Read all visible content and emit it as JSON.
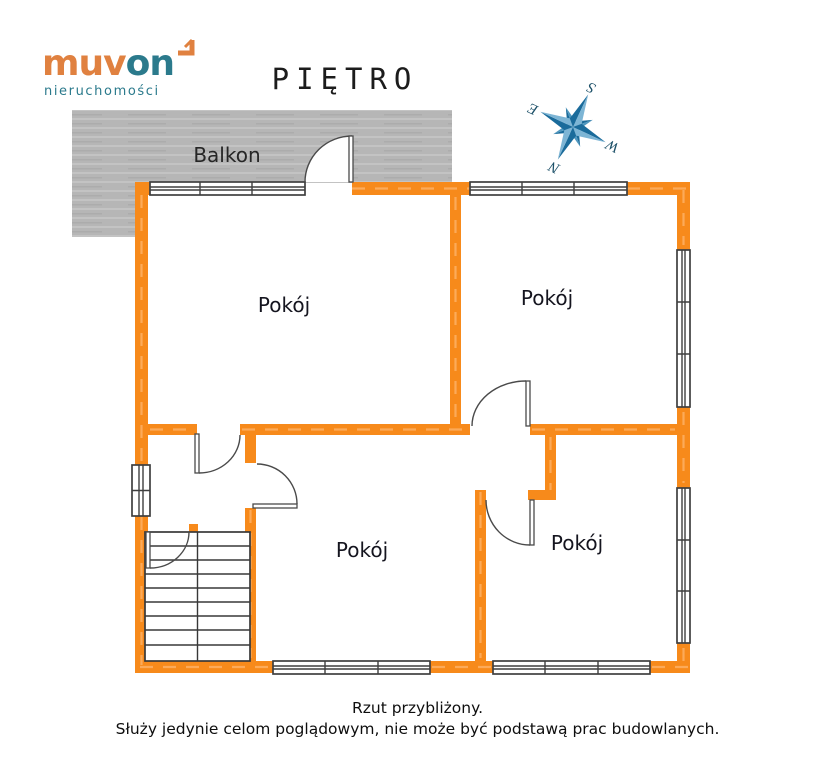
{
  "logo": {
    "brand_primary": "muv",
    "brand_secondary": "on",
    "tagline": "nieruchomości"
  },
  "title": "PIĘTRO",
  "compass": {
    "n": "N",
    "s": "S",
    "e": "E",
    "w": "W"
  },
  "plan": {
    "balcony_label": "Balkon",
    "rooms": [
      {
        "label": "Pokój"
      },
      {
        "label": "Pokój"
      },
      {
        "label": "Pokój"
      },
      {
        "label": "Pokój"
      }
    ]
  },
  "caption": {
    "line1": "Rzut przybliżony.",
    "line2": "Służy jedynie celom poglądowym, nie może być podstawą prac budowlanych."
  },
  "colors": {
    "wall_orange": "#F78A1B",
    "wall_dash": "#FDAE60",
    "balcony_gray": "#B6B6B6",
    "symbol_dark": "#3F3F3F",
    "compass_blue_dark": "#1A6B9B",
    "compass_blue_light": "#7DB5D5",
    "logo_orange": "#E08140",
    "logo_teal": "#2B7A8C"
  }
}
